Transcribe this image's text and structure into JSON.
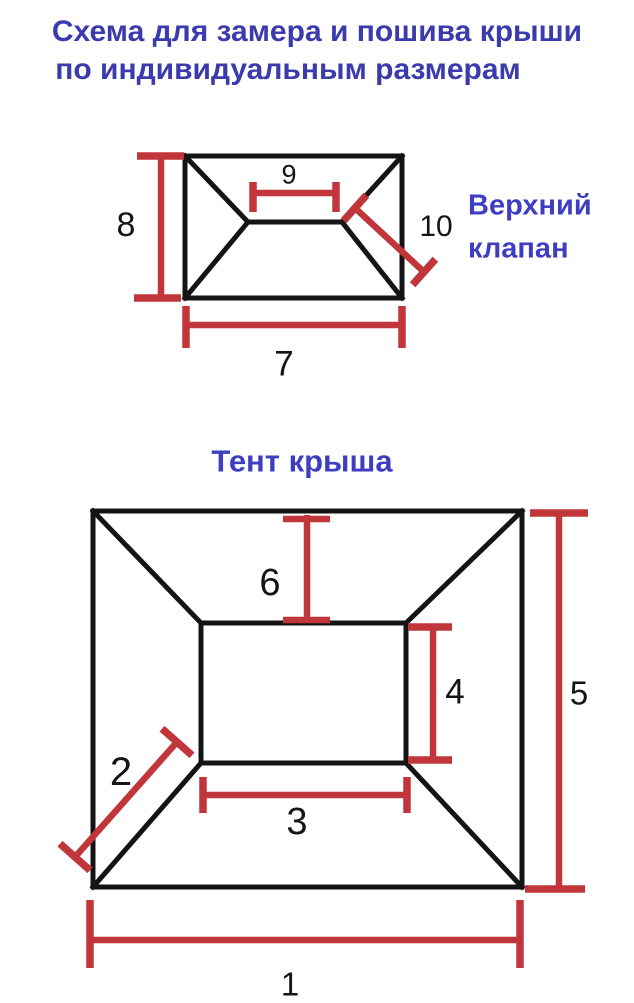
{
  "colors": {
    "title_blue": "#3b3bae",
    "label_blue": "#3e3ec3",
    "dim_red": "#c0363a",
    "line_black": "#141414",
    "background": "#ffffff"
  },
  "title": {
    "line1": "Схема для замера и пошива крыши",
    "line2": "по индивидуальным размерам"
  },
  "top_diagram": {
    "label_line1": "Верхний",
    "label_line2": "клапан",
    "dims": {
      "height": "8",
      "ridge": "9",
      "hip": "10",
      "width": "7"
    }
  },
  "bottom_diagram": {
    "title": "Тент крыша",
    "dims": {
      "slope_top": "6",
      "inner_height": "4",
      "outer_height": "5",
      "corner": "2",
      "inner_width": "3",
      "outer_width": "1"
    }
  }
}
